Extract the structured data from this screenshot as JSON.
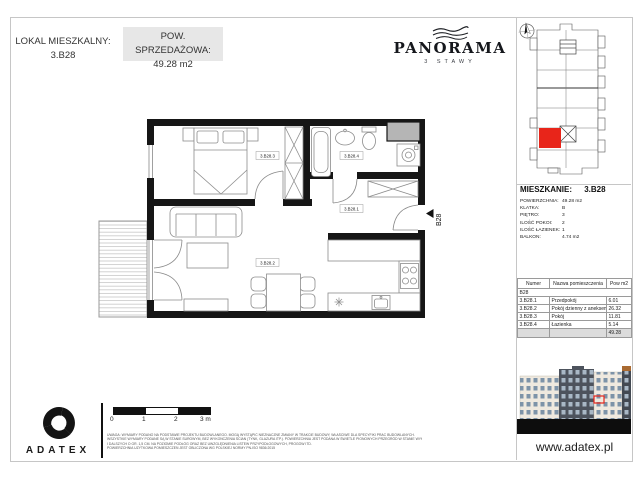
{
  "header": {
    "lokal_label": "LOKAL MIESZKALNY:",
    "lokal_value": "3.B28",
    "pow_label": "POW. SPRZEDAŻOWA:",
    "pow_value": "49.28 m2"
  },
  "brand": {
    "name": "PANORAMA",
    "subtitle": "3 STAWY"
  },
  "plan": {
    "labels": {
      "bedroom": "3.B28.3",
      "bathroom": "3.B28.4",
      "hall": "3.B28.1",
      "living": "3.B28.2"
    },
    "entrance_label": "B28"
  },
  "scale": {
    "t0": "0",
    "t1": "1",
    "t2": "2",
    "t3": "3 m"
  },
  "sidebar": {
    "apartment": {
      "heading_label": "MIESZKANIE:",
      "heading_value": "3.B28",
      "rows": [
        {
          "label": "POWIERZCHNIA:",
          "value": "49.28 m2"
        },
        {
          "label": "KLATKA:",
          "value": "B"
        },
        {
          "label": "PIĘTRO:",
          "value": "3"
        },
        {
          "label": "ILOŚĆ POKOI:",
          "value": "2"
        },
        {
          "label": "ILOŚĆ ŁAZIENEK:",
          "value": "1"
        },
        {
          "label": "BALKON:",
          "value": "4.74 m2"
        }
      ]
    },
    "table": {
      "h_numer": "Numer",
      "h_nazwa": "Nazwa pomieszczenia",
      "h_pow": "Pow m2",
      "group": "B28",
      "rows": [
        {
          "numer": "3.B28.1",
          "nazwa": "Przedpokój",
          "pow": "6.01"
        },
        {
          "numer": "3.B28.2",
          "nazwa": "Pokój dzienny z aneksem",
          "pow": "26.32"
        },
        {
          "numer": "3.B28.3",
          "nazwa": "Pokój",
          "pow": "11.81"
        },
        {
          "numer": "3.B28.4",
          "nazwa": "Łazienka",
          "pow": "5.14"
        }
      ],
      "total": "49.28"
    },
    "website": "www.adatex.pl"
  },
  "footer": {
    "logo": "ADATEX",
    "disclaimer": [
      "UWAGA: WYMIARY PODANO NA PODSTAWIE PROJEKTU BUDOWLANEGO. MOGĄ WYSTĄPIĆ NIEZNACZNE ZMIANY W TRAKCIE BUDOWY, WŁAŚCIWE DLA SPECYFIKI PRAC BUDOWLANYCH.",
      "WSZYSTKIE WYMIARY PODANE SĄ W STANIE SUROWYM, BEZ WYKOŃCZENIA ŚCIAN (TYNK, GLAZURA ITP.). POWIERZCHNIA JEST PODANA W ŚWIETLE PIONOWYCH PRZEGRÓD W STANIE WYKOŃCZONYM",
      "I DALSZYCH O GR. 1,5 CM. NA POZIOMIE PODŁÓG ORAZ BEZ UWZGLĘDNIENIA LISTEW PRZYPODŁOGOWYCH, PROGÓW ITD.",
      "POWIERZCHNIA UŻYTKOWA POMIESZCZEŃ JEST OBLICZONA WG POLSKIEJ NORMY PN-ISO 9836:2015"
    ]
  },
  "colors": {
    "accent_red": "#e8251a",
    "wall_black": "#161616",
    "panel_gray": "#e7e7e7",
    "shaft_gray": "#b5b5b5"
  }
}
